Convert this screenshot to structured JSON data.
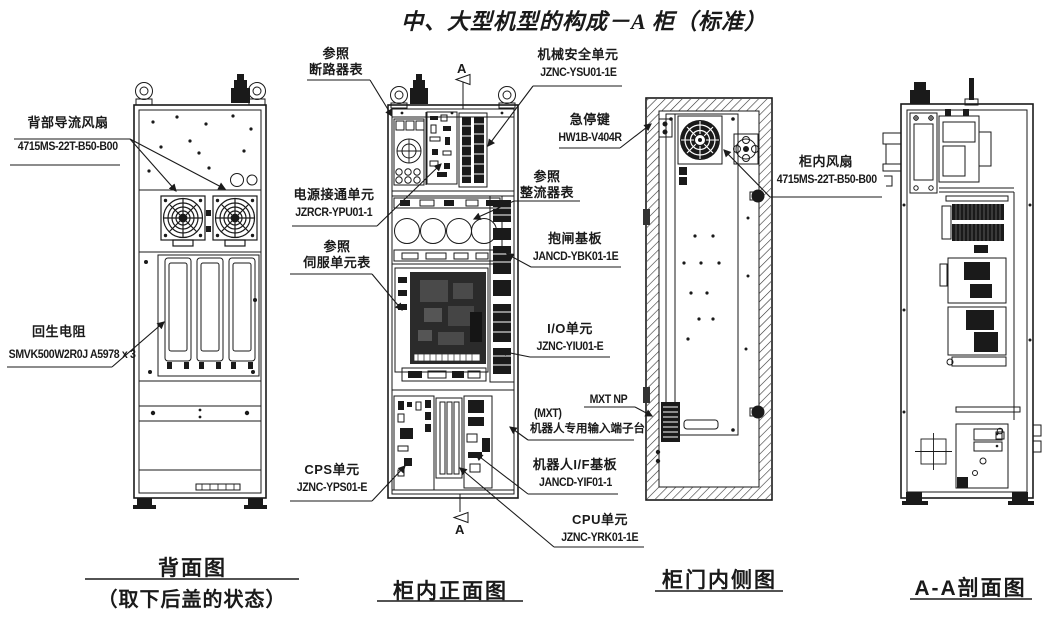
{
  "title": "中、大型机型的构成－A 柜（标准）",
  "section_marker": "A",
  "captions": {
    "back": "背面图",
    "back_sub": "（取下后盖的状态）",
    "front": "柜内正面图",
    "door": "柜门内侧图",
    "section": "A-A剖面图"
  },
  "labels": {
    "back_fan": {
      "line1": "背部导流风扇",
      "line2": "4715MS-22T-B50-B00"
    },
    "regen_resistor": {
      "line1": "回生电阻",
      "line2": "SMVK500W2R0J A5978 x 3"
    },
    "ref_breaker": {
      "line1": "参照",
      "line2": "断路器表"
    },
    "power_on_unit": {
      "line1": "电源接通单元",
      "line2": "JZRCR-YPU01-1"
    },
    "ref_servo": {
      "line1": "参照",
      "line2": "伺服单元表"
    },
    "cps_unit": {
      "line1": "CPS单元",
      "line2": "JZNC-YPS01-E"
    },
    "safety_unit": {
      "line1": "机械安全单元",
      "line2": "JZNC-YSU01-1E"
    },
    "estop": {
      "line1": "急停键",
      "line2": "HW1B-V404R"
    },
    "ref_rectifier": {
      "line1": "参照",
      "line2": "整流器表"
    },
    "brake_board": {
      "line1": "抱闸基板",
      "line2": "JANCD-YBK01-1E"
    },
    "io_unit": {
      "line1": "I/O单元",
      "line2": "JZNC-YIU01-E"
    },
    "mxt_np": {
      "line1": "MXT NP"
    },
    "mxt_terminal": {
      "line1": "(MXT)",
      "line2": "机器人专用输入端子台"
    },
    "robot_if_board": {
      "line1": "机器人I/F基板",
      "line2": "JANCD-YIF01-1"
    },
    "cpu_unit": {
      "line1": "CPU单元",
      "line2": "JZNC-YRK01-1E"
    },
    "cabinet_fan": {
      "line1": "柜内风扇",
      "line2": "4715MS-22T-B50-B00"
    }
  },
  "colors": {
    "line": "#1a1a1a",
    "background": "#ffffff"
  }
}
